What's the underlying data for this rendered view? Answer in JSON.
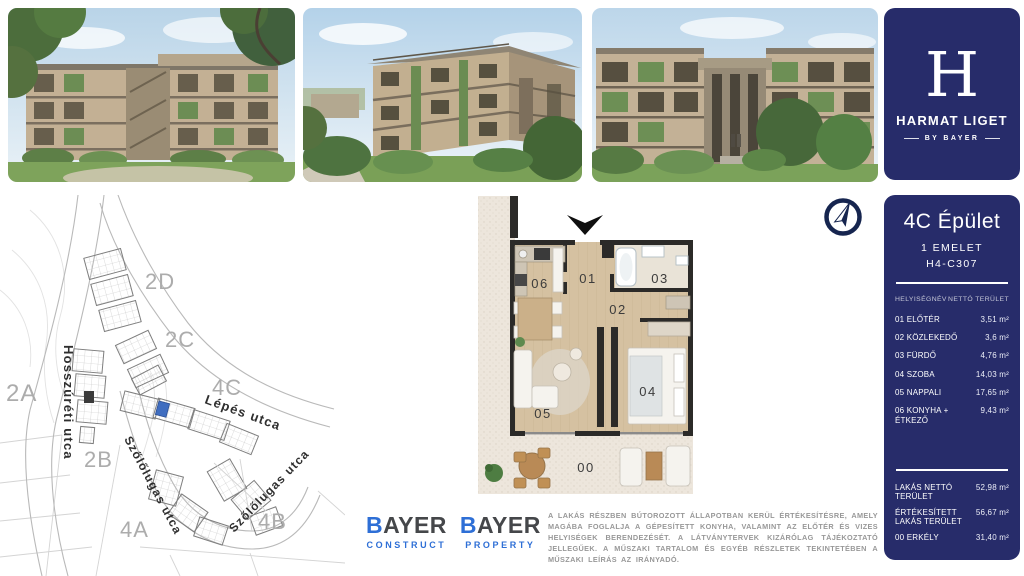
{
  "brand": {
    "monogram": "H",
    "title": "HARMAT LIGET",
    "subtitle": "BY BAYER",
    "navy": "#272c6a",
    "accent_blue": "#2e6fd6"
  },
  "photos": [
    {
      "label": "courtyard garden render"
    },
    {
      "label": "building corner render"
    },
    {
      "label": "street facade render"
    }
  ],
  "site_map": {
    "streets": [
      {
        "name": "Hosszúréti utca"
      },
      {
        "name": "Lépés utca"
      },
      {
        "name": "Szőlőlugas utca"
      },
      {
        "name": "Szőlőlugas utca"
      }
    ],
    "areas": [
      {
        "label": "2D"
      },
      {
        "label": "2C"
      },
      {
        "label": "2A"
      },
      {
        "label": "4C"
      },
      {
        "label": "2B"
      },
      {
        "label": "4A"
      },
      {
        "label": "4B"
      }
    ],
    "highlight_color": "#3f6dc0"
  },
  "icons": {
    "compass": "compass-north-icon",
    "entrance": "entrance-arrow-icon"
  },
  "floor_plan": {
    "rooms": [
      {
        "id": "01"
      },
      {
        "id": "02"
      },
      {
        "id": "03"
      },
      {
        "id": "04"
      },
      {
        "id": "05"
      },
      {
        "id": "06"
      },
      {
        "id": "00"
      }
    ]
  },
  "unit_panel": {
    "building": "4C Épület",
    "floor": "1 EMELET",
    "code": "H4-C307",
    "columns": {
      "name": "HELYISÉGNÉV",
      "area": "NETTÓ TERÜLET"
    },
    "rooms": [
      {
        "name": "01 ELŐTÉR",
        "area": "3,51 m²"
      },
      {
        "name": "02 KÖZLEKEDŐ",
        "area": "3,6 m²"
      },
      {
        "name": "03 FÜRDŐ",
        "area": "4,76 m²"
      },
      {
        "name": "04 SZOBA",
        "area": "14,03 m²"
      },
      {
        "name": "05 NAPPALI",
        "area": "17,65 m²"
      },
      {
        "name": "06 KONYHA + ÉTKEZŐ",
        "area": "9,43 m²"
      }
    ],
    "totals": [
      {
        "name": "LAKÁS NETTÓ TERÜLET",
        "area": "52,98 m²"
      },
      {
        "name": "ÉRTÉKESÍTETT LAKÁS TERÜLET",
        "area": "56,67 m²"
      },
      {
        "name": "00 ERKÉLY",
        "area": "31,40 m²"
      }
    ]
  },
  "footer": {
    "logos": [
      {
        "brand": "BAYER",
        "division": "CONSTRUCT"
      },
      {
        "brand": "BAYER",
        "division": "PROPERTY"
      }
    ],
    "disclaimer": "A LAKÁS RÉSZBEN BÚTOROZOTT ÁLLAPOTBAN KERÜL ÉRTÉKESÍTÉSRE, AMELY MAGÁBA FOGLALJA A GÉPESÍTETT KONYHA, VALAMINT AZ ELŐTÉR ÉS VIZES HELYISÉGEK BERENDEZÉSÉT. A LÁTVÁNYTERVEK KIZÁRÓLAG TÁJÉKOZTATÓ JELLEGŰEK. A MŰSZAKI TARTALOM ÉS EGYÉB RÉSZLETEK TEKINTETÉBEN A MŰSZAKI LEÍRÁS AZ IRÁNYADÓ."
  }
}
